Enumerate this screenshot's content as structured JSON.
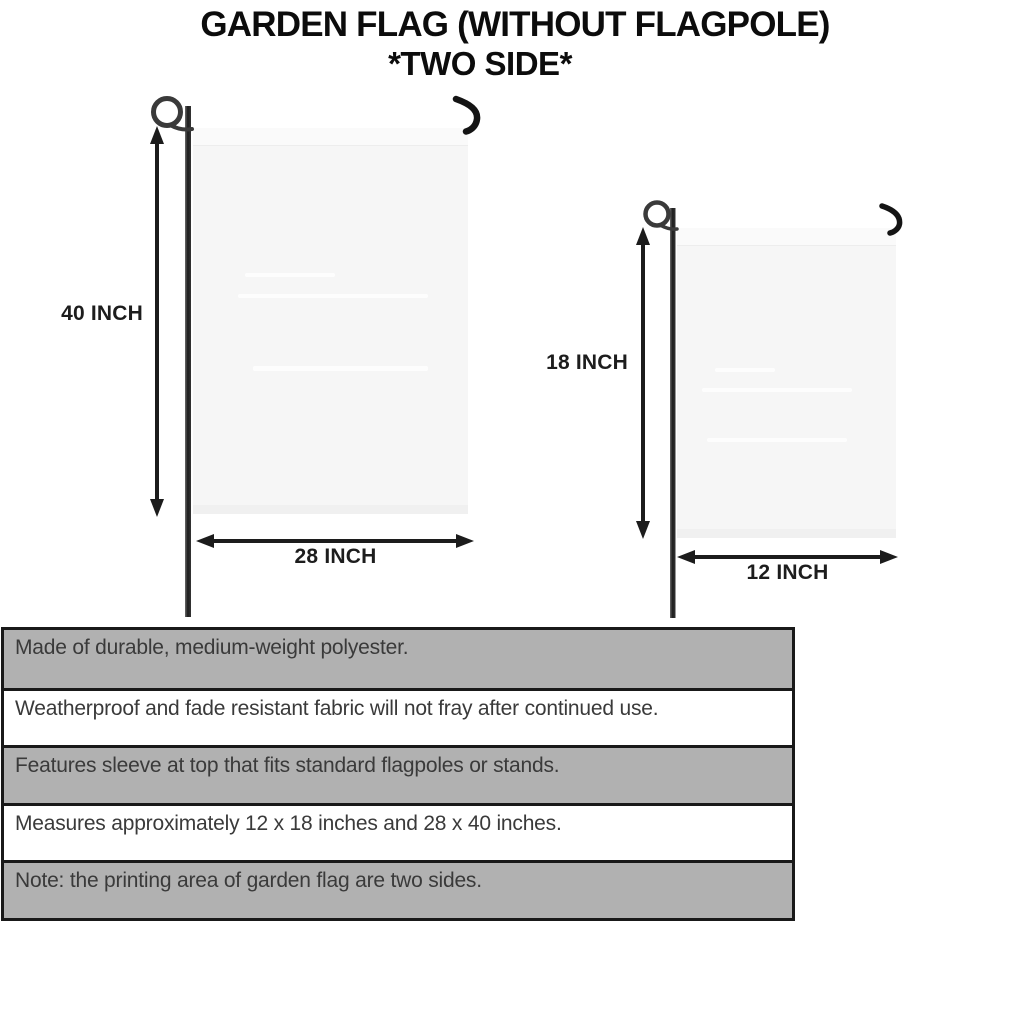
{
  "title": {
    "line1": "GARDEN FLAG (WITHOUT FLAGPOLE)",
    "line2": "*TWO SIDE*"
  },
  "flags": {
    "large": {
      "height_label": "40 INCH",
      "width_label": "28 INCH"
    },
    "small": {
      "height_label": "18 INCH",
      "width_label": "12 INCH"
    }
  },
  "features": {
    "rows": [
      {
        "text": "Made of durable, medium-weight polyester."
      },
      {
        "text": "Weatherproof and fade resistant fabric will not fray after continued use."
      },
      {
        "text": "Features sleeve at top that fits standard flagpoles or stands."
      },
      {
        "text": "Measures approximately 12 x 18 inches and 28 x 40 inches."
      },
      {
        "text": "Note: the printing area of garden flag are two sides."
      }
    ]
  },
  "colors": {
    "shaded_row": "#b1b1b1",
    "plain_row": "#ffffff",
    "table_border": "#191919",
    "flag_fill": "#f6f6f6",
    "arrow": "#1c1c1c",
    "pole": "#2e2e2e",
    "body_text": "#3a3a3a",
    "title_text": "#0c0c0c"
  }
}
